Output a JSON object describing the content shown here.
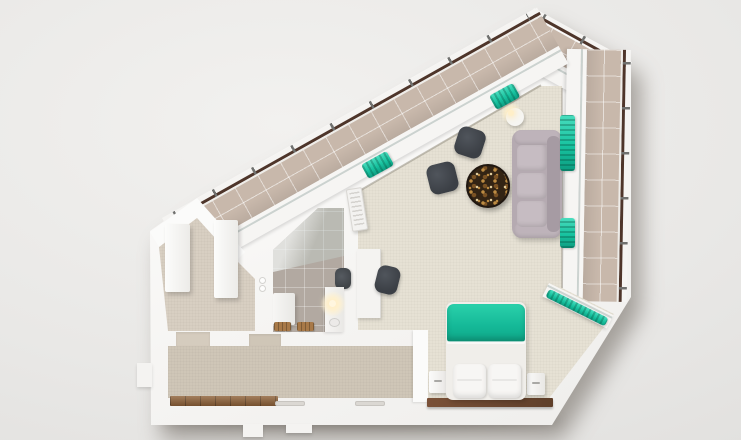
{
  "scene": {
    "title": "apartment-floor-plan-3d-render-top-view",
    "type": "architectural-cutaway-render",
    "rooms": [
      {
        "name": "balcony-terrace",
        "floor": "beige-tiles",
        "features": [
          "wood-edge-railing",
          "metal-posts",
          "wraps-top-and-right-sides"
        ]
      },
      {
        "name": "living-room",
        "floor": "cream-carpet",
        "furniture": [
          "three-seat-sofa",
          "round-mosaic-coffee-table",
          "armchair",
          "armchair",
          "wall-desk",
          "office-chair",
          "side-table-with-lamp",
          "ac-unit"
        ]
      },
      {
        "name": "bedroom",
        "floor": "cream-carpet",
        "furniture": [
          "double-bed-teal-blanket",
          "pillow",
          "pillow",
          "nightstand",
          "nightstand",
          "wood-headboard-panel"
        ]
      },
      {
        "name": "bathroom",
        "floor": "taupe-tiles",
        "furniture": [
          "glass-shower",
          "toilet",
          "vanity-with-sink",
          "lit-mirror",
          "cabinet",
          "toilet-paper-rolls",
          "wood-bath-mats"
        ]
      },
      {
        "name": "hallway",
        "floor": "beige-carpet",
        "furniture": [
          "wardrobe",
          "wardrobe"
        ]
      },
      {
        "name": "corridor",
        "floor": "beige-carpet",
        "furniture": [
          "entry-wood-threshold",
          "floor-vent",
          "floor-vent"
        ]
      }
    ],
    "accents": [
      "teal-curtains-at-windows",
      "teal-bed-blanket"
    ]
  },
  "palette": {
    "railing": "#4e352a",
    "post": "#70716f",
    "glass": "#ccd3d0",
    "balconyTile": "#c8b8ab",
    "carpetMain": "#e6e1d4",
    "carpetDim": "#cfc6b7",
    "carpetHall": "#d8cfc2",
    "bathTile": "#b2a9a1",
    "teal": "#18c3a0",
    "tealHi": "#49ddbe",
    "tealShadow": "#0d9c80",
    "sofaBase": "#b5aab1",
    "sofaCushion": "#c6bcc2",
    "sofaBack": "#a69ba3",
    "chair": "#3b3f45",
    "chairHi": "#50555c",
    "tableWood": "#332414",
    "speckle1": "#bd8c43",
    "speckle2": "#7a5224",
    "speckle3": "#e4cf9f",
    "bedSheet": "#f0eeea",
    "pillow": "#f7f6f4"
  }
}
